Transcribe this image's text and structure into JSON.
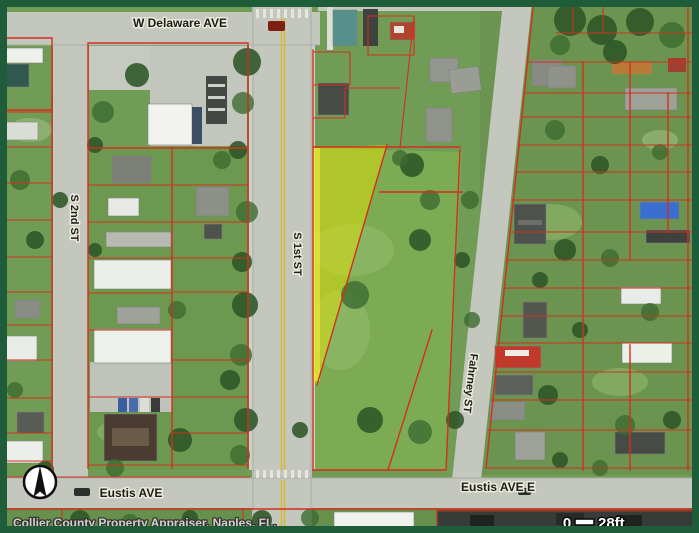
{
  "map": {
    "street_labels": {
      "w_delaware": "W Delaware AVE",
      "s_2nd": "S 2nd ST",
      "s_1st": "S 1st ST",
      "fahrney": "Fahrney ST",
      "eustis": "Eustis AVE",
      "eustis_e": "Eustis AVE E"
    },
    "attribution": "Collier County Property Appraiser, Naples, FL.",
    "scale_bar": {
      "zero": "0",
      "distance": "28ft"
    },
    "icons": {
      "north_arrow": "north-arrow"
    },
    "colors": {
      "frame": "#1e5c3a",
      "parcel_line": "#d2301c",
      "highlight": "#e8e400",
      "road": "#c3c7be",
      "grass": "#719c55",
      "label_text": "#1c1c1c",
      "label_halo": "#eceada"
    }
  }
}
